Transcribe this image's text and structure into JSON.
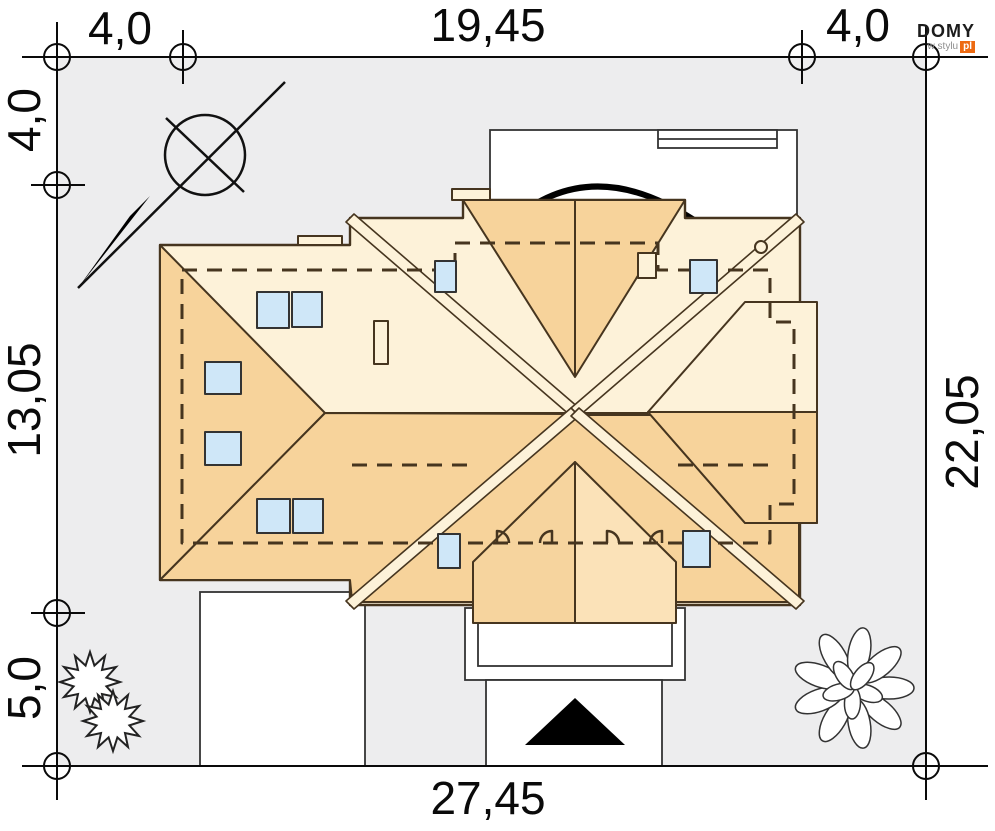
{
  "plan": {
    "type": "house-site-plan-roof-view",
    "dimensions": {
      "top": [
        "4,0",
        "19,45",
        "4,0"
      ],
      "left": [
        "4,0",
        "13,05",
        "5,0"
      ],
      "right": [
        "22,05"
      ],
      "bottom": [
        "27,45"
      ]
    },
    "symbols": [
      "north-arrow",
      "plot-boundary-markers",
      "conifer-bush",
      "deciduous-tree",
      "entrance-arrow",
      "door-swings",
      "skylight-windows",
      "chimneys"
    ],
    "colors": {
      "plot_gray": "#ededee",
      "roof_dark": "#f7d39b",
      "roof_light": "#fdf2d9",
      "roof_mid_left": "#f6d49e",
      "roof_mid_right": "#fbe2b8",
      "window_blue": "#cfe7f8",
      "roof_line": "#46351f",
      "site_line": "#1a1a1a",
      "logo_orange": "#ed6a12"
    }
  },
  "logo": {
    "brand": "DOMY",
    "tagline": "w stylu",
    "suffix": "pl"
  }
}
